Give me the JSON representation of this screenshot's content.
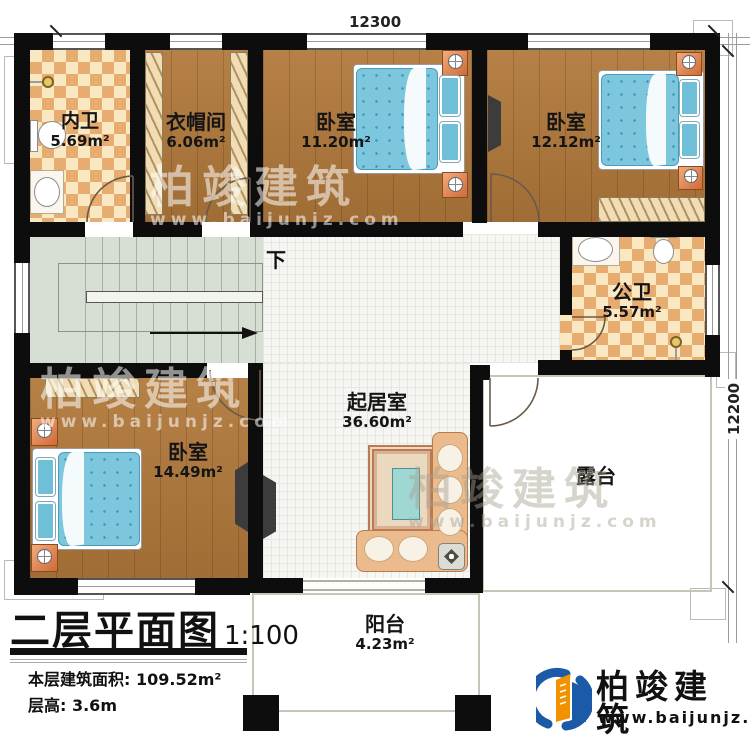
{
  "plan": {
    "dimensions": {
      "top": "12300",
      "right": "12200"
    },
    "rooms": [
      {
        "name": "内卫",
        "area": "5.69m²"
      },
      {
        "name": "衣帽间",
        "area": "6.06m²"
      },
      {
        "name": "卧室",
        "area": "11.20m²"
      },
      {
        "name": "卧室",
        "area": "12.12m²"
      },
      {
        "name": "公卫",
        "area": "5.57m²"
      },
      {
        "name": "卧室",
        "area": "14.49m²"
      },
      {
        "name": "起居室",
        "area": "36.60m²"
      },
      {
        "name": "露台",
        "area": ""
      },
      {
        "name": "阳台",
        "area": "4.23m²"
      }
    ],
    "stairs": {
      "direction_label": "下"
    }
  },
  "title_block": {
    "title": "二层平面图",
    "scale": "1:100",
    "floor_area_line": "本层建筑面积: 109.52m²",
    "floor_height_line": "层高: 3.6m"
  },
  "watermark": {
    "brand": "柏竣建筑",
    "url": "www.baijunjz.com"
  },
  "logo": {
    "brand": "柏竣建筑",
    "url": "www.baijunjz.com"
  },
  "colors": {
    "wall": "#0d0d0d",
    "wood_floor": "#b1793b",
    "tile_light": "#f9e8c2",
    "tile_dark": "#e7ac70",
    "hall_tile": "#f6f6f2",
    "outdoor_floor": "#edead8",
    "stair_floor": "#d7ded4",
    "bed_blue": "#7cc7de",
    "furniture_orange": "#e08a59",
    "logo_blue": "#1a5aa6",
    "logo_orange": "#f29200"
  }
}
